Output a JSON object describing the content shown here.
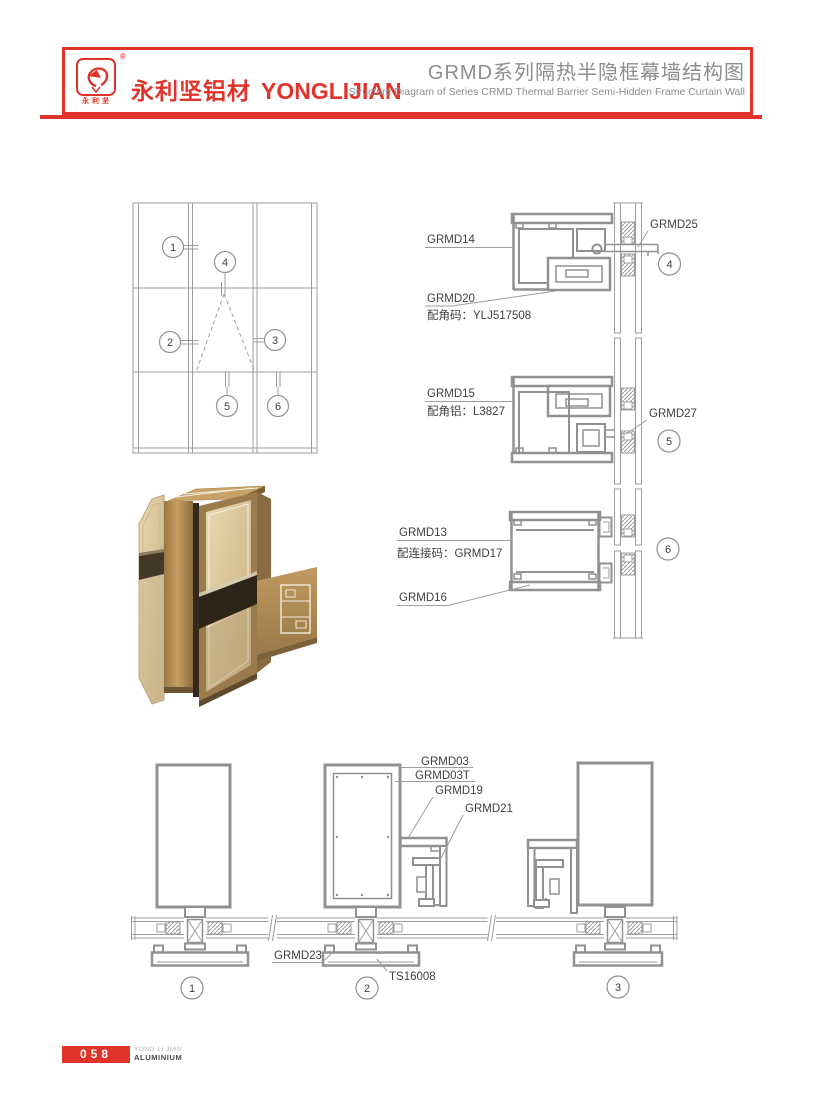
{
  "colors": {
    "brand_red": "#e0342b",
    "title_gray": "#8b8d8f",
    "drawing_gray": "#8f9193",
    "bronze": "#b08a52",
    "glass_tan": "#d9c9a4"
  },
  "header": {
    "registered": "®",
    "logo_chars": "永利坚",
    "brand_cn": "永利坚铝材",
    "brand_en": "YONGLIJIAN",
    "title_cn": "GRMD系列隔热半隐框幕墙结构图",
    "title_en": "Structure Diagram of Series CRMD Thermal Barrier Semi-Hidden Frame Curtain Wall"
  },
  "elevation": {
    "markers": [
      "1",
      "2",
      "3",
      "4",
      "5",
      "6"
    ]
  },
  "details": {
    "d4": {
      "marker": "4",
      "label_main": "GRMD14",
      "label_sub": "GRMD20",
      "label_sub_note": "配角码：YLJ517508",
      "label_right": "GRMD25"
    },
    "d5": {
      "marker": "5",
      "label_main": "GRMD15",
      "label_main_note": "配角铝：L3827",
      "label_right": "GRMD27"
    },
    "d6": {
      "marker": "6",
      "label_main": "GRMD13",
      "label_main_note": "配连接码：GRMD17",
      "label_bottom": "GRMD16"
    }
  },
  "bottom": {
    "labels": {
      "grmd03": "GRMD03",
      "grmd03t": "GRMD03T",
      "grmd19": "GRMD19",
      "grmd21": "GRMD21",
      "grmd23": "GRMD23",
      "ts16008": "TS16008"
    },
    "markers": [
      "1",
      "2",
      "3"
    ]
  },
  "footer": {
    "page_number": "058",
    "brand_line1": "YONG LI JIAN",
    "brand_line2": "ALUMINIUM"
  }
}
